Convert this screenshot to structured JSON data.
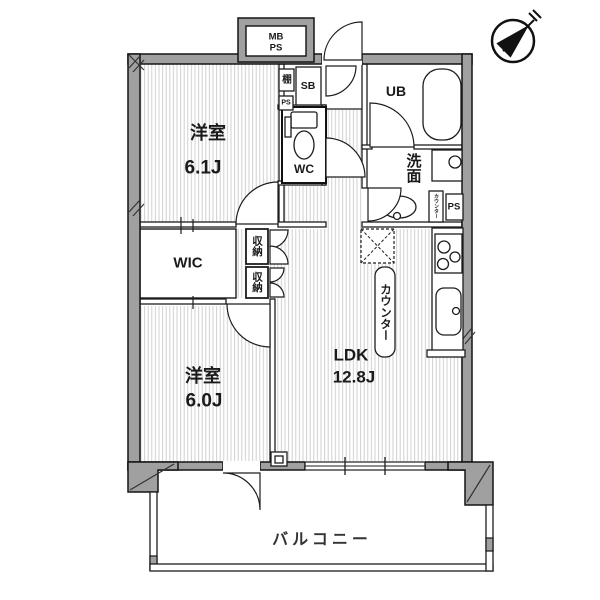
{
  "plan": {
    "bedroom1": {
      "name": "洋室",
      "size": "6.1J"
    },
    "bedroom2": {
      "name": "洋室",
      "size": "6.0J"
    },
    "ldk": {
      "name": "LDK",
      "size": "12.8J"
    },
    "wic": "WIC",
    "wc": "WC",
    "ub": "UB",
    "washroom": "洗面",
    "storage_upper": "収納",
    "storage_lower": "収納",
    "kitchen_counter": "カウンター",
    "washroom_counter": "カウンター",
    "shoe_box": "SB",
    "shelf": "棚",
    "ps_top": "PS",
    "ps_washroom": "PS",
    "meter_box": {
      "line1": "MB",
      "line2": "PS"
    },
    "balcony": "バルコニー"
  },
  "colors": {
    "wall_fill": "#a0a0a0",
    "outline": "#1d1d1d",
    "floor_stripe": "#d0d0d0",
    "background": "#ffffff"
  }
}
